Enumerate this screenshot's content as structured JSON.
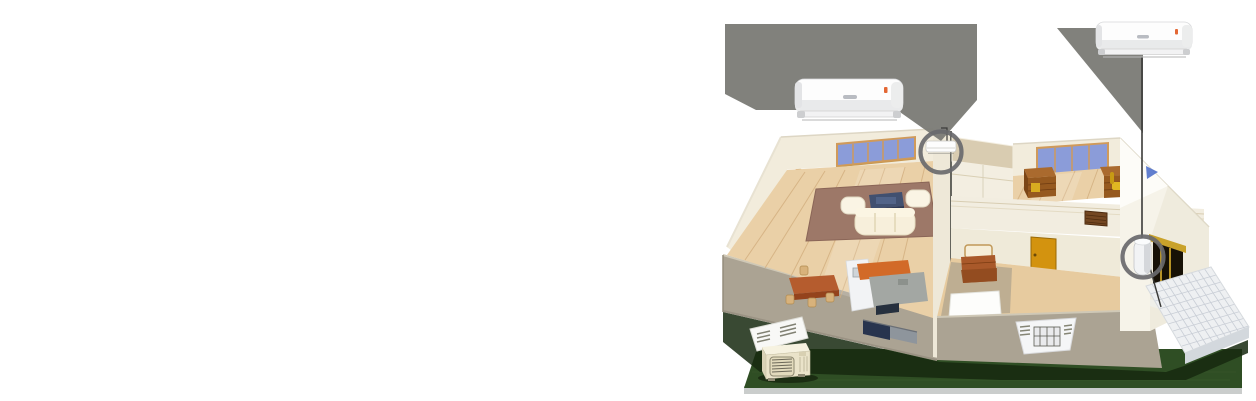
{
  "canvas": {
    "width": 1256,
    "height": 401,
    "background": "#ffffff"
  },
  "illustration": {
    "name": "wall-split-ac-house-installation-demo",
    "callout_product_units": [
      "indoor-unit-product-left",
      "indoor-unit-product-right"
    ],
    "highlight_circles": [
      "living-room-indoor-unit",
      "entry-corner-unit"
    ],
    "house_features": [
      "living-room",
      "kitchen-dining",
      "study-room",
      "hallway-room",
      "entry-porch",
      "outdoor-unit",
      "lawn"
    ],
    "colors": {
      "callout_gray": "#7c7c77",
      "ring_gray": "#69696c",
      "leader_line": "#3a3a38",
      "lawn_green": "#2f4e24",
      "lawn_shadow": "#16290f",
      "ground_strip": "#c4c8c6",
      "wall_cream": "#f2ecdc",
      "wall_front_tan": "#aba393",
      "floor_wood": "#ead0a7",
      "rug_mauve": "#9d7868",
      "window_blue": "#8b9cd9",
      "window_frame_tan": "#d09a5a",
      "sofa_cream": "#f7efdb",
      "tv_navy": "#415070",
      "counter_orange": "#d26a28",
      "countertop_gray": "#a3a7a3",
      "dining_brown": "#b55c2e",
      "chair_tan": "#d8b27b",
      "desk_brown": "#96591f",
      "chair_yellow": "#e0b722",
      "door_yellow": "#d3930f",
      "vent_brown": "#744722",
      "ac_white": "#fdfdfd",
      "ac_indicator_red": "#e0561e",
      "porch_tile": "#eef0f2",
      "gable_logo_blue": "#4668c8",
      "doorway_dark": "#171106",
      "stripe_yellow": "#c9a22a"
    }
  }
}
